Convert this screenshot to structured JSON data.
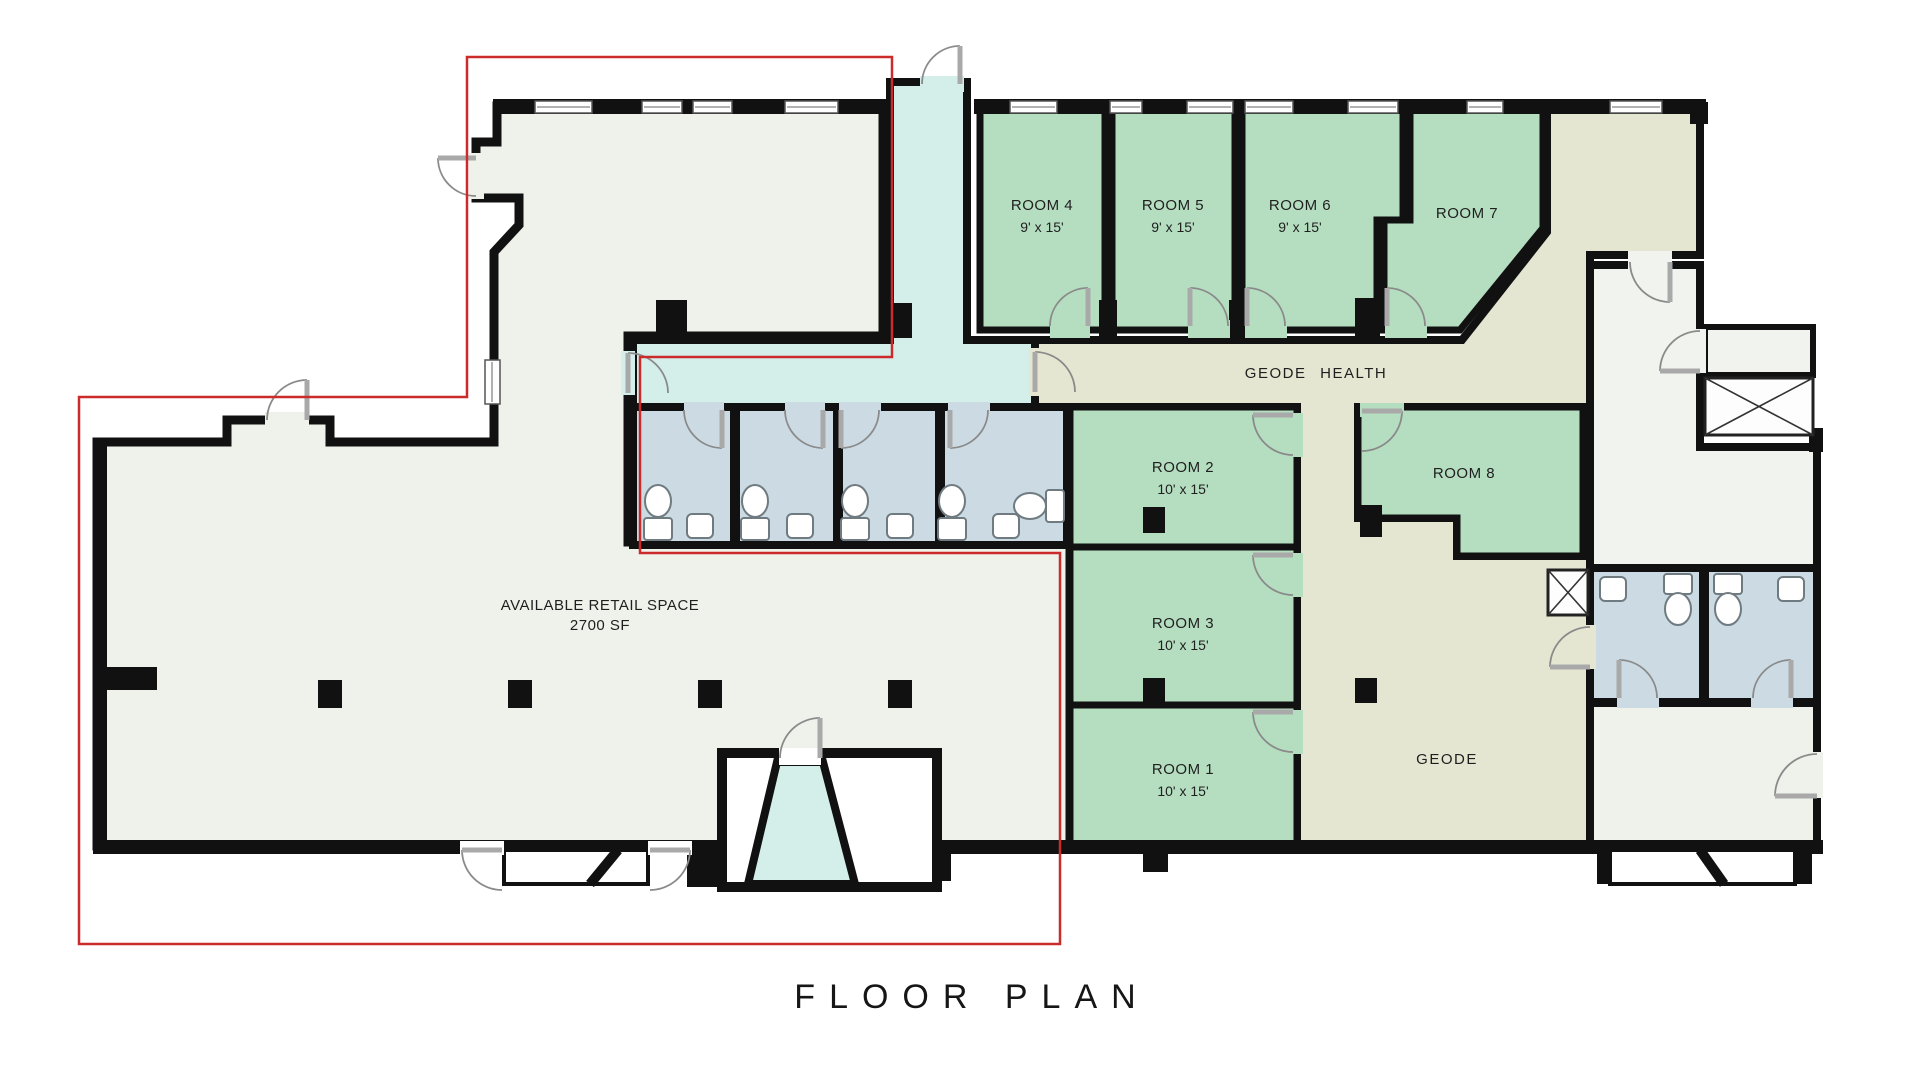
{
  "title": "FLOOR PLAN",
  "retail": {
    "label": "AVAILABLE RETAIL SPACE",
    "area": "2700 SF"
  },
  "suites": {
    "geode_health": "GEODE HEALTH",
    "geode": "GEODE"
  },
  "rooms": [
    {
      "name": "ROOM 1",
      "dims": "10' x 15'"
    },
    {
      "name": "ROOM 2",
      "dims": "10' x 15'"
    },
    {
      "name": "ROOM 3",
      "dims": "10' x 15'"
    },
    {
      "name": "ROOM 4",
      "dims": "9' x 15'"
    },
    {
      "name": "ROOM 5",
      "dims": "9' x 15'"
    },
    {
      "name": "ROOM 6",
      "dims": "9' x 15'"
    },
    {
      "name": "ROOM 7",
      "dims": ""
    },
    {
      "name": "ROOM 8",
      "dims": ""
    }
  ],
  "colors": {
    "wall": "#111111",
    "red": "#cb2b2a",
    "green": "#b5dec1",
    "cyan": "#d4efea",
    "beige": "#e5e6d2",
    "blue": "#ccdbe3",
    "ivory": "#eff2ea",
    "white_room": "#f1f3ee",
    "door": "#8a8a8a",
    "text": "#1f1f1f"
  }
}
